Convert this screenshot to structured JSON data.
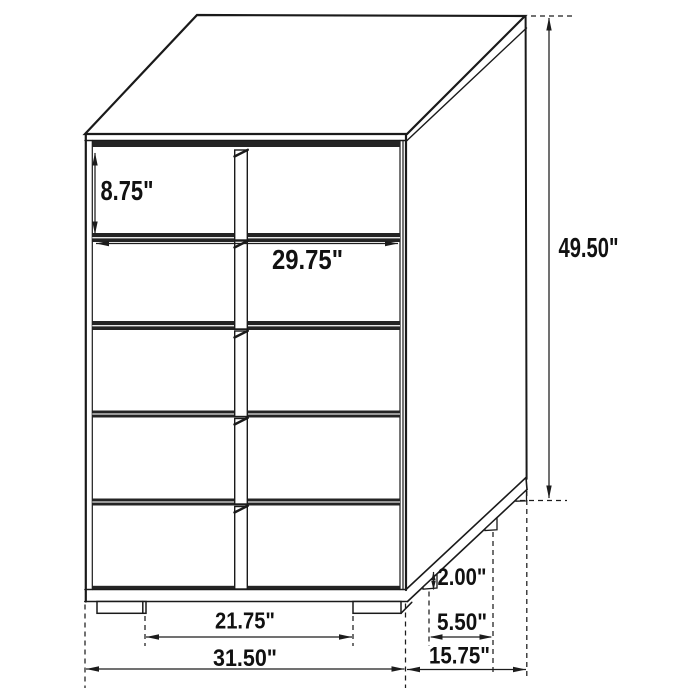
{
  "diagram": {
    "subject": "5-drawer chest dimension diagram",
    "view": "three-quarter perspective line drawing",
    "drawer_count": 5,
    "colors": {
      "line": "#1a1a1a",
      "background": "#ffffff",
      "divider_band": "#242424",
      "dimension_text": "#111111"
    },
    "dims": {
      "drawer_height": "8.75\"",
      "interior_width": "29.75\"",
      "overall_height": "49.50\"",
      "foot_height": "2.00\"",
      "side_foot_spacing": "5.50\"",
      "front_foot_spacing": "21.75\"",
      "overall_width": "31.50\"",
      "overall_depth": "15.75\""
    }
  }
}
